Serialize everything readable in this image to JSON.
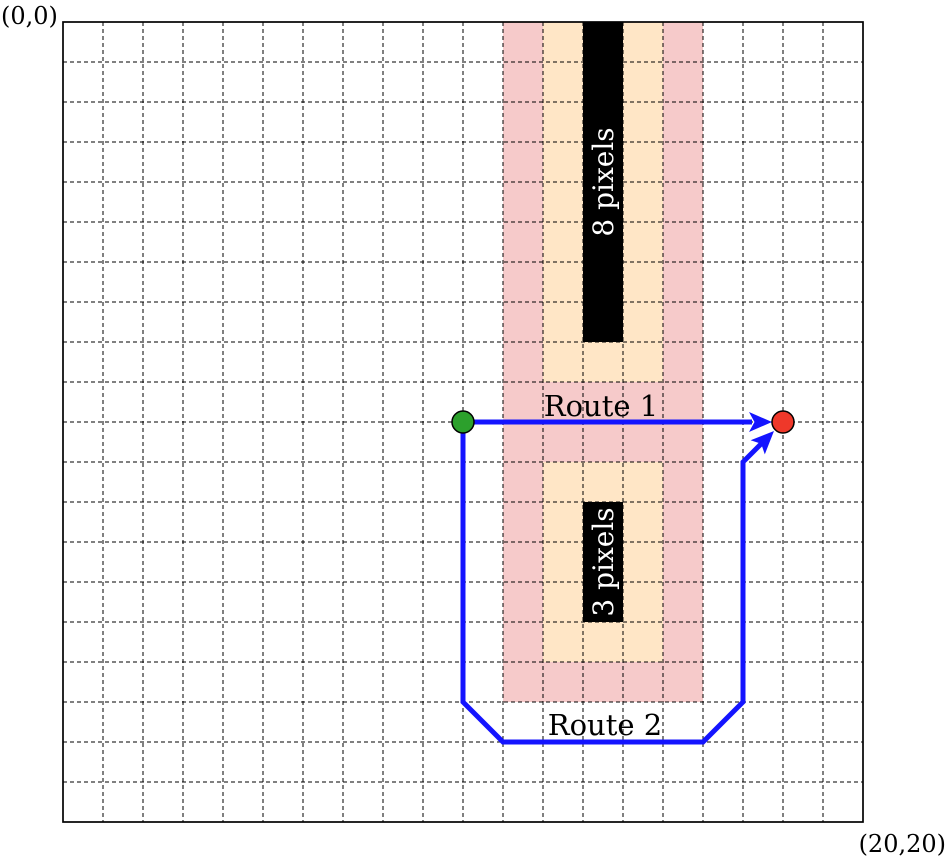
{
  "figure": {
    "grid": {
      "cols": 20,
      "rows": 20
    },
    "labels": {
      "origin": "(0,0)",
      "far_corner": "(20,20)",
      "route1": "Route 1",
      "route2": "Route 2",
      "obstacle_top": "8 pixels",
      "obstacle_bottom": "3 pixels"
    },
    "colors": {
      "background": "#ffffff",
      "grid_line": "#000000",
      "border": "#000000",
      "inflation_outer": "#f6caca",
      "inflation_inner": "#ffe6c6",
      "obstacle": "#000000",
      "obstacle_text": "#ffffff",
      "route": "#1414ff",
      "start_marker": "#2ca02c",
      "end_marker": "#ef382a",
      "label_text": "#000000"
    }
  }
}
